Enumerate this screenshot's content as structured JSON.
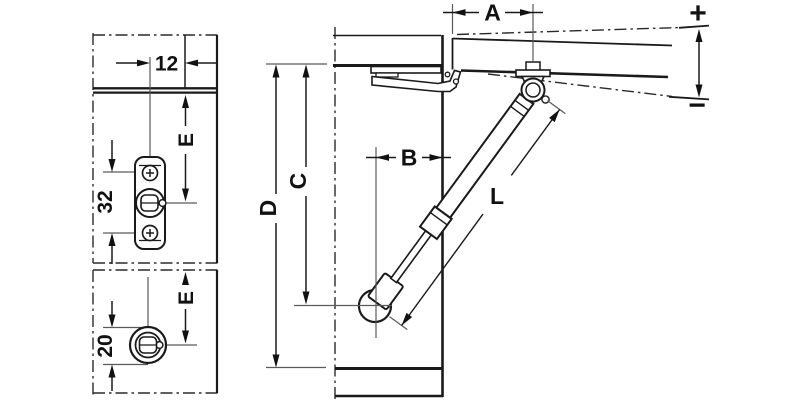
{
  "diagram_labels": {
    "upper_detail": {
      "offset": "12",
      "screw_spacing": "32",
      "height_e": "E"
    },
    "lower_detail": {
      "diameter": "20",
      "height_e": "E"
    },
    "main_view": {
      "dim_a": "A",
      "dim_b": "B",
      "dim_c": "C",
      "dim_d": "D",
      "strut_length": "L",
      "adjust_plus": "+",
      "adjust_minus": "−"
    }
  },
  "colors": {
    "line": "#1a1a1a",
    "thin_line": "#5a5a5a",
    "background": "#ffffff"
  }
}
